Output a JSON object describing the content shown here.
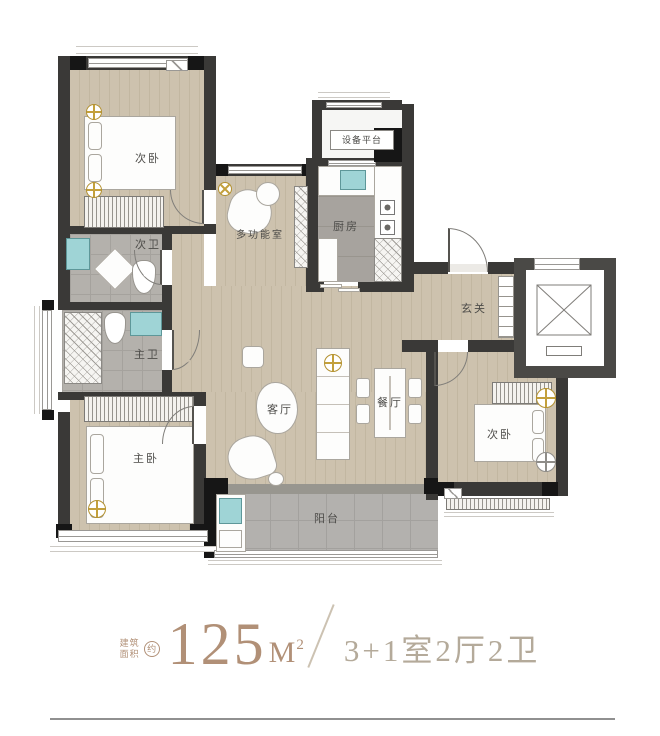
{
  "rooms": {
    "bedroom_top": {
      "label": "次卧"
    },
    "bath_second": {
      "label": "次卫"
    },
    "bath_master": {
      "label": "主卫"
    },
    "bedroom_master": {
      "label": "主卧"
    },
    "multifunction": {
      "label": "多功能室"
    },
    "kitchen": {
      "label": "厨房"
    },
    "equipment_platform": {
      "label": "设备平台"
    },
    "entry": {
      "label": "玄关"
    },
    "living": {
      "label": "客厅"
    },
    "dining": {
      "label": "餐厅"
    },
    "balcony": {
      "label": "阳台"
    },
    "bedroom_right": {
      "label": "次卧"
    }
  },
  "caption": {
    "prefix_line1": "建筑",
    "prefix_line2": "面积",
    "approx": "约",
    "area_value": "125",
    "area_unit": "M",
    "area_sup": "2",
    "layout_spec": "3+1室2厅2卫"
  },
  "icons": {
    "ceiling_light_icon": "crosshair-in-circle",
    "elevator_shaft_icon": "box-with-x",
    "door_swing_icon": "quarter-arc"
  },
  "colors": {
    "accent_bronze": "#b19077",
    "spec_text": "#b4aa9a",
    "slash": "#ccc2b2",
    "wall": "#3a3937",
    "wall_dark": "#161616",
    "fixture": "#9fd4d6",
    "gold": "#c3a03c",
    "divider": "#909090"
  }
}
